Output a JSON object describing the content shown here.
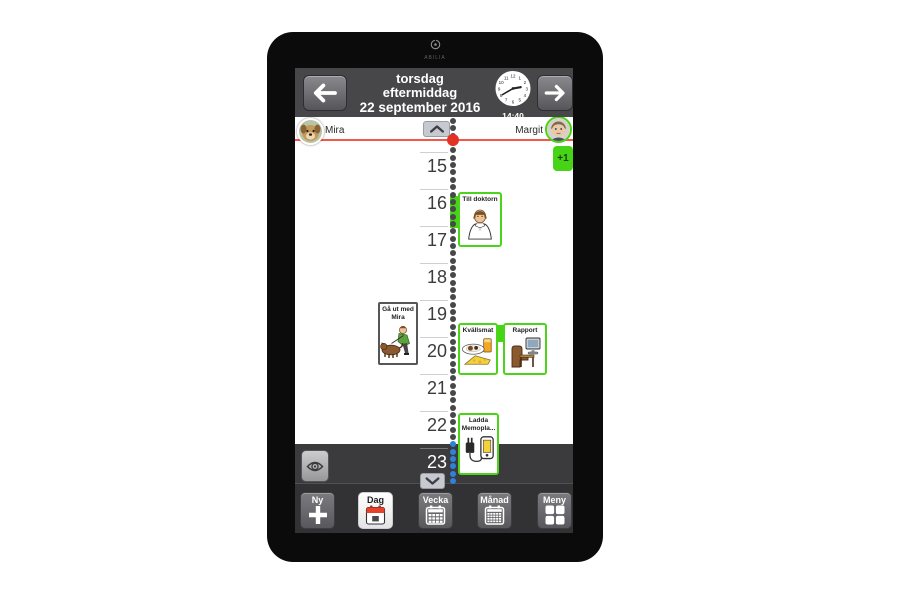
{
  "device": {
    "brand": "ABILIA"
  },
  "header": {
    "day_name": "torsdag",
    "day_part": "eftermiddag",
    "date": "22 september 2016",
    "clock_time": "14:40",
    "prev_icon": "arrow-left-icon",
    "next_icon": "arrow-right-icon"
  },
  "users": {
    "left": {
      "name": "Mira",
      "avatar": "dog-photo"
    },
    "right": {
      "name": "Margit",
      "avatar": "woman-photo",
      "active": true
    }
  },
  "overflow_badge": "+1",
  "timeline": {
    "hours": [
      "14",
      "15",
      "16",
      "17",
      "18",
      "19",
      "20",
      "21",
      "22",
      "23"
    ],
    "current_time": "14:40",
    "collapse_top_icon": "chevron-up-icon",
    "collapse_bottom_icon": "chevron-down-icon"
  },
  "activities": [
    {
      "title": "Till doktorn",
      "icon": "doctor",
      "side": "right"
    },
    {
      "title": "Gå ut med Mira",
      "icon": "dog-walk",
      "side": "left"
    },
    {
      "title": "Kvällsmat",
      "icon": "evening-meal",
      "side": "right"
    },
    {
      "title": "Rapport",
      "icon": "computer-desk",
      "side": "right"
    },
    {
      "title": "Ladda Memopla...",
      "icon": "charger",
      "side": "right"
    }
  ],
  "sidebar": {
    "show_label_icon": "eye-icon"
  },
  "toolbar": {
    "buttons": [
      {
        "label": "Ny",
        "icon": "plus-icon"
      },
      {
        "label": "Dag",
        "icon": "day-calendar-icon",
        "active": true
      },
      {
        "label": "Vecka",
        "icon": "week-calendar-icon"
      },
      {
        "label": "Månad",
        "icon": "month-calendar-icon"
      },
      {
        "label": "Meny",
        "icon": "menu-grid-icon"
      }
    ]
  },
  "colors": {
    "accent_green": "#47d316",
    "current_time_red": "#f6564a",
    "night_dot_blue": "#2f82d8",
    "header_gray": "#47474a"
  }
}
